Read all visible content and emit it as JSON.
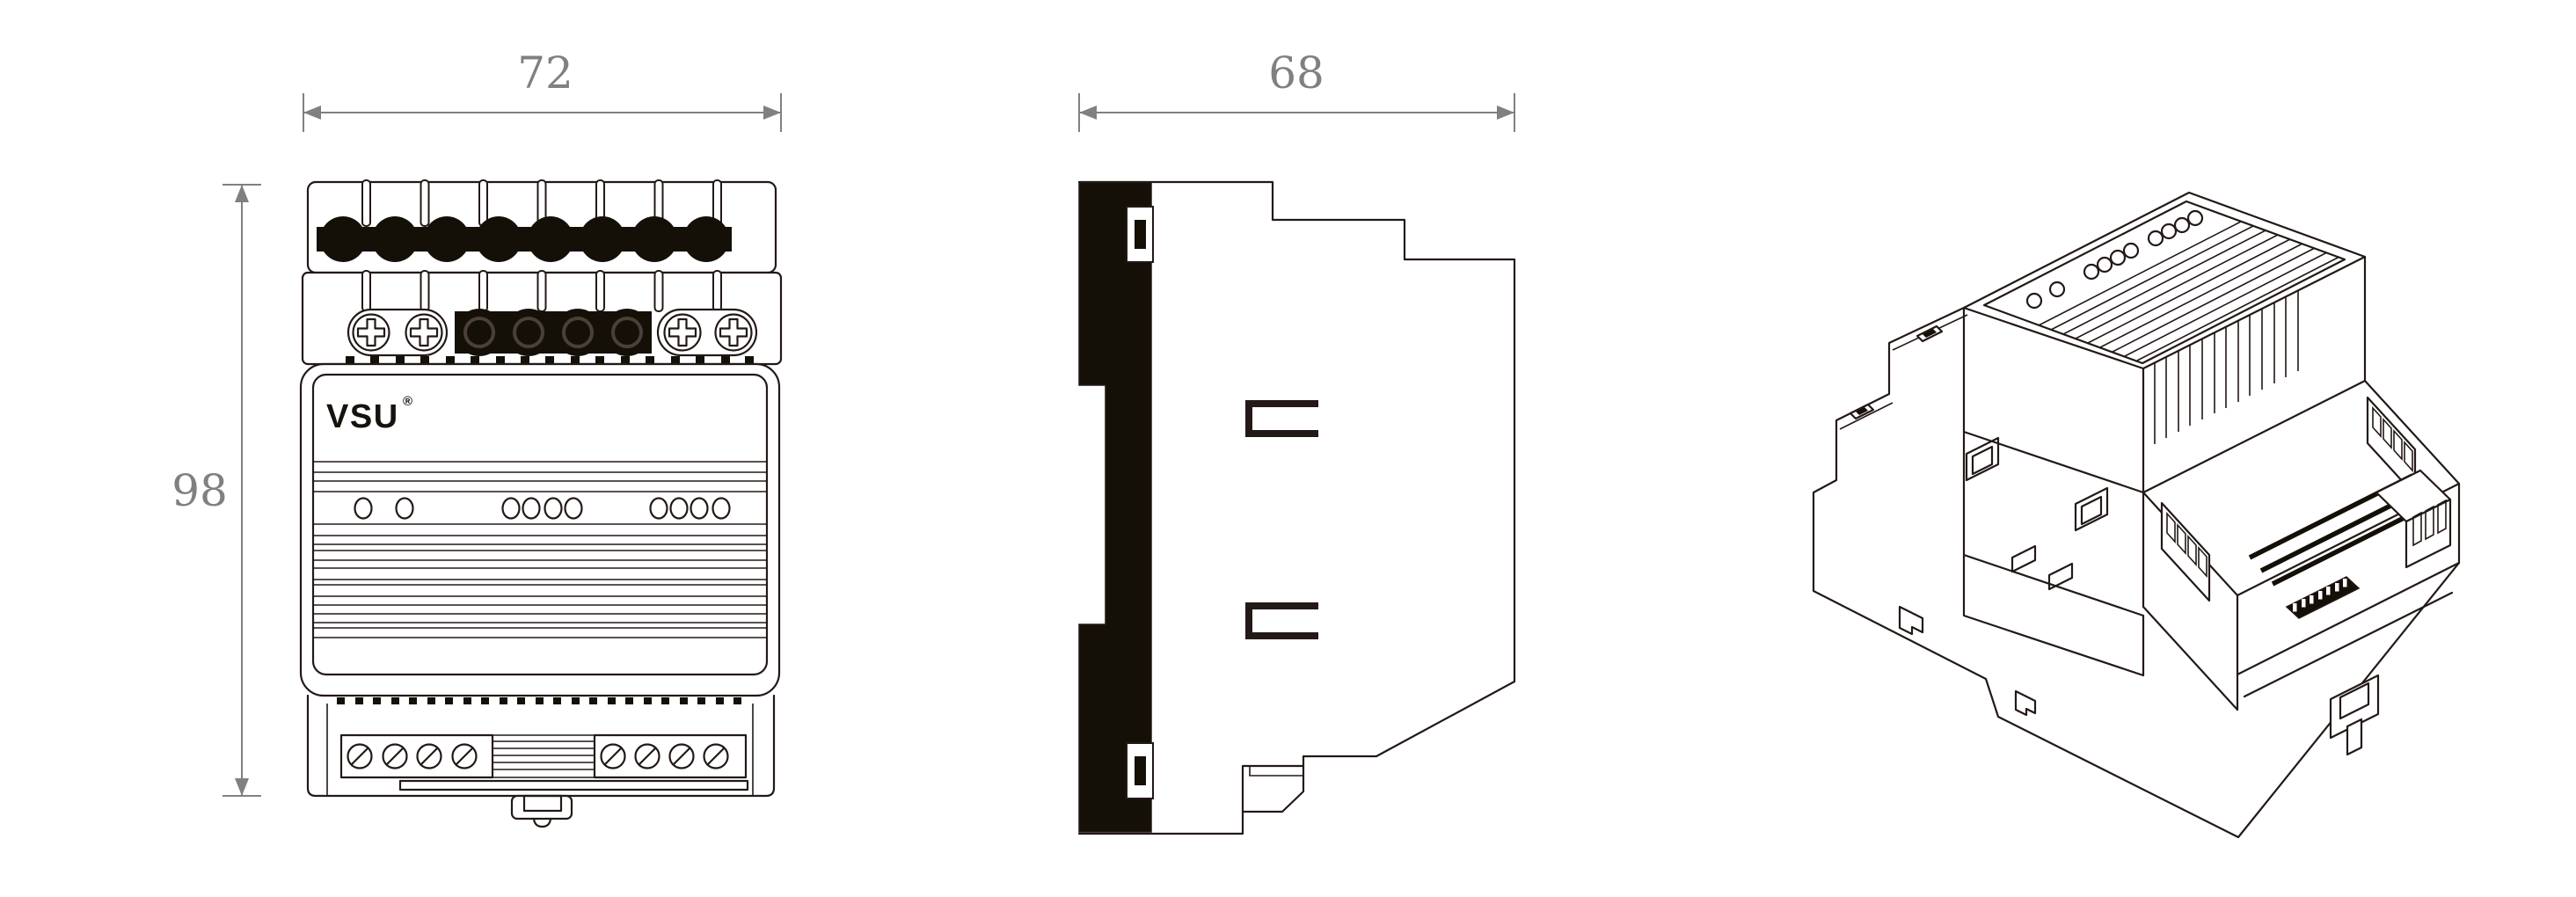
{
  "page": {
    "title": "DIN-rail module dimensional drawing",
    "background": "#ffffff"
  },
  "colors": {
    "line": "#231916",
    "dimension_gray": "#808080",
    "terminal_black": "#141008",
    "paper": "#ffffff"
  },
  "branding": {
    "logo": "VSU",
    "registered_mark": "®"
  },
  "dimensions": {
    "front_width_mm": "72",
    "front_height_mm": "98",
    "side_depth_mm": "68"
  },
  "views": {
    "front": {
      "name": "front-orthographic-view",
      "top_terminal_holes": 8,
      "io_row_black_terminals": 4,
      "io_row_phillips_screws": 4,
      "led_groups": [
        2,
        4,
        4
      ],
      "bottom_slotted_screws": 8
    },
    "side": {
      "name": "side-profile-view",
      "mount_brackets": 2,
      "rail_notches": 2
    },
    "isometric": {
      "name": "isometric-view",
      "top_hole_groups": [
        1,
        1,
        4,
        4
      ],
      "terrace_vent_slots": 3,
      "connector_pin_slots": 4
    }
  }
}
